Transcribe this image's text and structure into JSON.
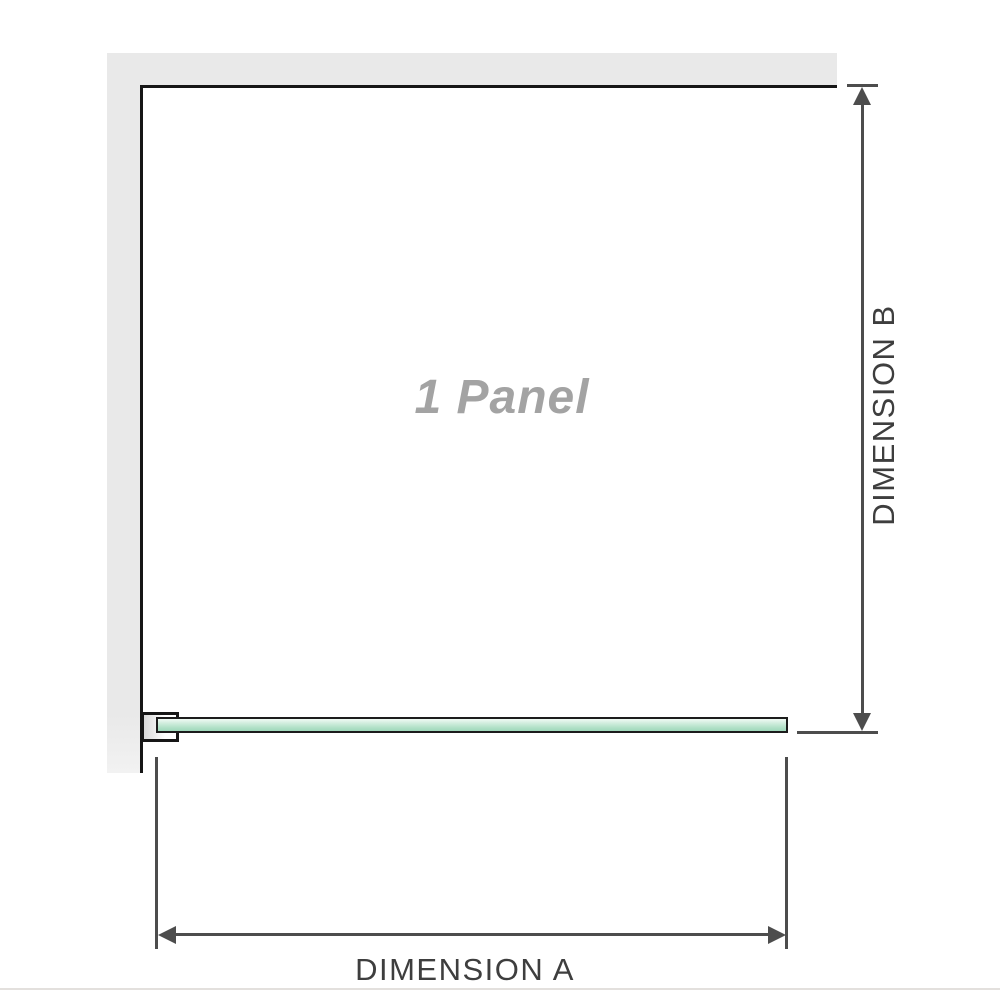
{
  "diagram": {
    "description": "Single glass panel shower screen plan-view dimension diagram",
    "labels": {
      "panel": "1 Panel",
      "dimension_a": "DIMENSION A",
      "dimension_b": "DIMENSION B"
    },
    "colors": {
      "wall_fill": "#e9e9e9",
      "outline": "#161616",
      "dimension_line": "#4d4d4d",
      "glass_fill": "#b2e1c8",
      "glass_border": "#1c1c1c",
      "panel_label_text": "#a3a3a3",
      "dimension_text": "#3e3e3e",
      "background": "#ffffff"
    }
  }
}
